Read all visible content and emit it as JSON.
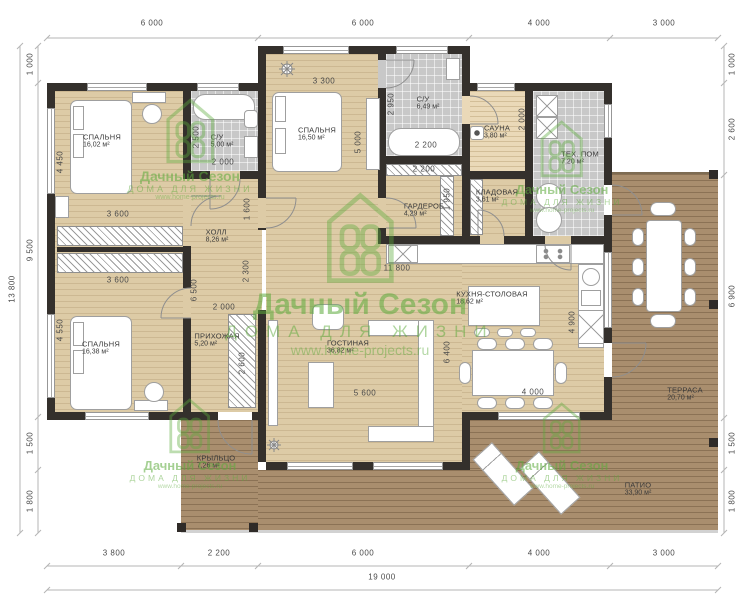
{
  "brand": {
    "name": "Дачный Сезон",
    "tagline": "ДОМА ДЛЯ ЖИЗНИ",
    "url": "www.home-projects.ru",
    "green": "#5dab3c"
  },
  "rooms": [
    {
      "name": "СПАЛЬНЯ",
      "area": "16,02 м²",
      "x": 102,
      "y": 141
    },
    {
      "name": "С/У",
      "area": "5,00 м²",
      "x": 222,
      "y": 141
    },
    {
      "name": "СПАЛЬНЯ",
      "area": "16,50 м²",
      "x": 317,
      "y": 134
    },
    {
      "name": "С/У",
      "area": "6,49 м²",
      "x": 428,
      "y": 103
    },
    {
      "name": "САУНА",
      "area": "3,80 м²",
      "x": 497,
      "y": 132
    },
    {
      "name": "ТЕХ. ПОМ",
      "area": "7,20 м²",
      "x": 580,
      "y": 158
    },
    {
      "name": "КЛАДОВАЯ",
      "area": "3,61 м²",
      "x": 497,
      "y": 196
    },
    {
      "name": "ГАРДЕРОБ",
      "area": "4,29 м²",
      "x": 424,
      "y": 210
    },
    {
      "name": "ХОЛЛ",
      "area": "8,26 м²",
      "x": 217,
      "y": 236
    },
    {
      "name": "ПРИХОЖАЯ",
      "area": "5,20 м²",
      "x": 217,
      "y": 340
    },
    {
      "name": "ГОСТИНАЯ",
      "area": "36,82 м²",
      "x": 348,
      "y": 347
    },
    {
      "name": "КУХНЯ-СТОЛОВАЯ",
      "area": "18,62 м²",
      "x": 492,
      "y": 298
    },
    {
      "name": "СПАЛЬНЯ",
      "area": "16,38 м²",
      "x": 101,
      "y": 348
    },
    {
      "name": "КРЫЛЬЦО",
      "area": "7,26 м²",
      "x": 216,
      "y": 462
    },
    {
      "name": "ТЕРРАСА",
      "area": "20,70 м²",
      "x": 685,
      "y": 394
    },
    {
      "name": "ПАТИО",
      "area": "33,90 м²",
      "x": 638,
      "y": 489
    }
  ],
  "dimensions": {
    "top": [
      {
        "t": "6 000",
        "x": 152,
        "y": 23
      },
      {
        "t": "6 000",
        "x": 363,
        "y": 23
      },
      {
        "t": "4 000",
        "x": 539,
        "y": 23
      },
      {
        "t": "3 000",
        "x": 664,
        "y": 23
      }
    ],
    "bottom": [
      {
        "t": "3 800",
        "x": 114,
        "y": 553
      },
      {
        "t": "2 200",
        "x": 219,
        "y": 553
      },
      {
        "t": "6 000",
        "x": 363,
        "y": 553
      },
      {
        "t": "4 000",
        "x": 539,
        "y": 553
      },
      {
        "t": "3 000",
        "x": 664,
        "y": 553
      }
    ],
    "total": {
      "t": "19 000",
      "x": 382,
      "y": 577
    },
    "left": [
      {
        "t": "1 000",
        "x": 30,
        "y": 64,
        "v": true
      },
      {
        "t": "9 500",
        "x": 30,
        "y": 250,
        "v": true
      },
      {
        "t": "1 500",
        "x": 30,
        "y": 443,
        "v": true
      },
      {
        "t": "1 800",
        "x": 30,
        "y": 501,
        "v": true
      }
    ],
    "left_total": {
      "t": "13 800",
      "x": 12,
      "y": 289,
      "v": true
    },
    "right": [
      {
        "t": "1 000",
        "x": 732,
        "y": 64,
        "v": true
      },
      {
        "t": "2 600",
        "x": 732,
        "y": 129,
        "v": true
      },
      {
        "t": "6 900",
        "x": 732,
        "y": 296,
        "v": true
      },
      {
        "t": "1 500",
        "x": 732,
        "y": 443,
        "v": true
      },
      {
        "t": "1 800",
        "x": 732,
        "y": 501,
        "v": true
      }
    ],
    "inner": [
      {
        "t": "4 450",
        "x": 60,
        "y": 162,
        "v": true
      },
      {
        "t": "3 600",
        "x": 118,
        "y": 214
      },
      {
        "t": "3 600",
        "x": 118,
        "y": 280
      },
      {
        "t": "4 550",
        "x": 60,
        "y": 330,
        "v": true
      },
      {
        "t": "2 500",
        "x": 196,
        "y": 137,
        "v": true
      },
      {
        "t": "2 000",
        "x": 223,
        "y": 162
      },
      {
        "t": "1 600",
        "x": 247,
        "y": 209,
        "v": true
      },
      {
        "t": "3 300",
        "x": 324,
        "y": 81
      },
      {
        "t": "5 000",
        "x": 358,
        "y": 142,
        "v": true
      },
      {
        "t": "2 950",
        "x": 391,
        "y": 104,
        "v": true
      },
      {
        "t": "2 200",
        "x": 426,
        "y": 145
      },
      {
        "t": "2 200",
        "x": 424,
        "y": 169
      },
      {
        "t": "1 950",
        "x": 447,
        "y": 199,
        "v": true
      },
      {
        "t": "2 000",
        "x": 522,
        "y": 119,
        "v": true
      },
      {
        "t": "2 300",
        "x": 246,
        "y": 271,
        "v": true
      },
      {
        "t": "6 500",
        "x": 194,
        "y": 290,
        "v": true
      },
      {
        "t": "2 000",
        "x": 224,
        "y": 307
      },
      {
        "t": "2 600",
        "x": 242,
        "y": 363,
        "v": true
      },
      {
        "t": "11 800",
        "x": 397,
        "y": 268
      },
      {
        "t": "6 400",
        "x": 447,
        "y": 352,
        "v": true
      },
      {
        "t": "4 900",
        "x": 572,
        "y": 322,
        "v": true
      },
      {
        "t": "5 600",
        "x": 365,
        "y": 393
      },
      {
        "t": "4 000",
        "x": 533,
        "y": 392
      }
    ]
  },
  "watermarks": [
    {
      "cx": 190,
      "logo_top": 98,
      "logo_w": 52,
      "logo_h": 66,
      "t1": 14,
      "t2": 9,
      "t3": 7
    },
    {
      "cx": 562,
      "logo_top": 120,
      "logo_w": 46,
      "logo_h": 58,
      "t1": 13,
      "t2": 8.5,
      "t3": 6.5
    },
    {
      "cx": 360,
      "logo_top": 192,
      "logo_w": 72,
      "logo_h": 92,
      "t1": 30,
      "t2": 17,
      "t3": 14,
      "big": true
    },
    {
      "cx": 190,
      "logo_top": 398,
      "logo_w": 44,
      "logo_h": 56,
      "t1": 13,
      "t2": 8.5,
      "t3": 6.5
    },
    {
      "cx": 562,
      "logo_top": 402,
      "logo_w": 42,
      "logo_h": 52,
      "t1": 13,
      "t2": 8.5,
      "t3": 6.5
    }
  ]
}
